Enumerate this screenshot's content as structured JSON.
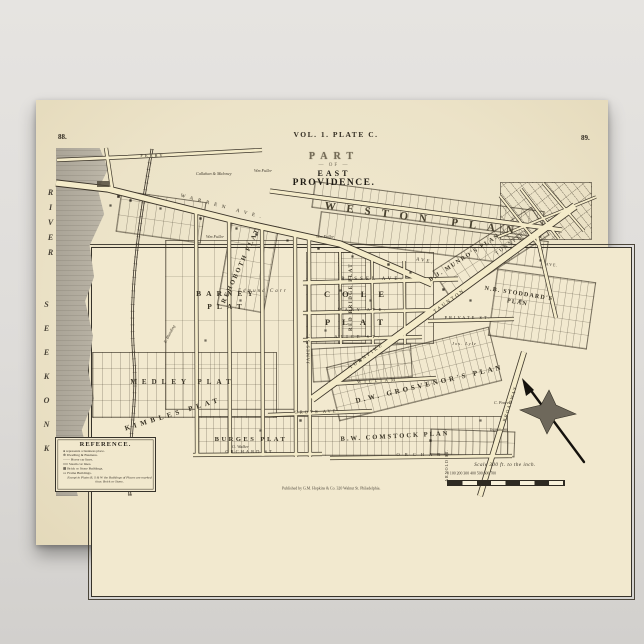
{
  "poster": {
    "page_no_left": "88.",
    "page_no_right": "89.",
    "plate_header": "VOL. 1. PLATE C.",
    "title": {
      "part": "PART",
      "of": "— OF —",
      "east": "EAST",
      "providence": "PROVIDENCE."
    }
  },
  "river": {
    "word_top": "RIVER",
    "word_bottom": "SEEKONK"
  },
  "plats": {
    "rehoboth": "REHOBOTH PLAT",
    "weston": "WESTON PLAN",
    "red_bridge": "RED BRIDGE PLAT",
    "barney": "BARNEY PLAT",
    "cole_top": "COLE",
    "cole_bottom": "PLAT",
    "medley": "MEDLEY PLAT",
    "kimbles": "KIMBLES PLAT",
    "burges": "BURGES PLAT",
    "comstock": "B.W. COMSTOCK PLAN",
    "grosvenor": "D.W. GROSVENOR'S PLAN",
    "munro": "B.J. MUNRO'S PLAN",
    "stoddard": "N.B. STODDARD'S PLAN"
  },
  "streets": {
    "warren": "WARREN AVE.",
    "warren_cont": "AVE.",
    "ferry": "FERRY",
    "russel": "RUSSEL AVE.",
    "mary": "MARY AVE.",
    "alice": "ALICE ST.",
    "private_st": "PRIVATE ST.",
    "william": "WILLIAM",
    "grove": "GROVE AVE.",
    "orchard_left": "ORCHARD ST.",
    "orchard_right": "ORCHARD",
    "taunton": "TAUNTON",
    "turnpike_upper": "TURNPIKE",
    "turnpike_lower": "TURNPIKE",
    "james": "JAMES ST.",
    "broadway": "BROADWAY",
    "arnold": "ARNOLD ST.",
    "ave_right": "AVE."
  },
  "owners": {
    "callahan": "Callahan & Maloney",
    "fuller_top": "Wm Fuller",
    "fuller_mid": "Wm Fuller",
    "fuller_east": "Wm Fuller",
    "carr": "Edmund Carr",
    "blanding": "E. Blanding",
    "lyle": "Jos. Lyle",
    "pearce": "C. Pearce",
    "ingraham": "Ingrahams",
    "walker": "G. Walker"
  },
  "reference": {
    "title": "REFERENCE.",
    "lines": [
      "●  represents a business place.",
      "⊕  Dwelling & Business.",
      "——  Horse car lines.",
      "══  Steam car lines.",
      "▦  Brick or Stone Buildings.",
      "▭  Frame Buildings."
    ],
    "footnote": "Except in Plates R, S & W the Buildings of Places are marked thus: Brick or Stone."
  },
  "scale": {
    "label": "Scale 300 ft. to the inch.",
    "ticks": "0      100     200     300     400     500     600     700"
  },
  "imprint": "Published by G.M. Hopkins & Co. 320 Walnut St. Philadelphia."
}
